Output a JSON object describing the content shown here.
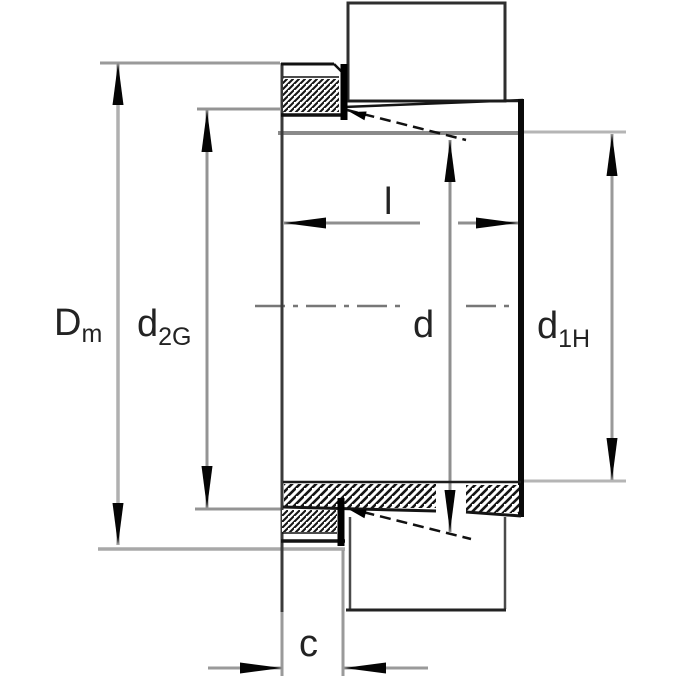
{
  "drawing": {
    "kind": "adapter-sleeve-dimension-drawing",
    "labels": {
      "dm": {
        "main": "D",
        "sub": "m"
      },
      "d2g": {
        "main": "d",
        "sub": "2G"
      },
      "l": {
        "main": "l",
        "sub": ""
      },
      "d": {
        "main": "d",
        "sub": ""
      },
      "d1h": {
        "main": "d",
        "sub": "1H"
      },
      "c": {
        "main": "c",
        "sub": ""
      }
    },
    "colors": {
      "ink": "#1c1c1c",
      "dim_gray": "#8f8f8f",
      "light_gray": "#b5b5b5",
      "background": "#ffffff"
    }
  }
}
